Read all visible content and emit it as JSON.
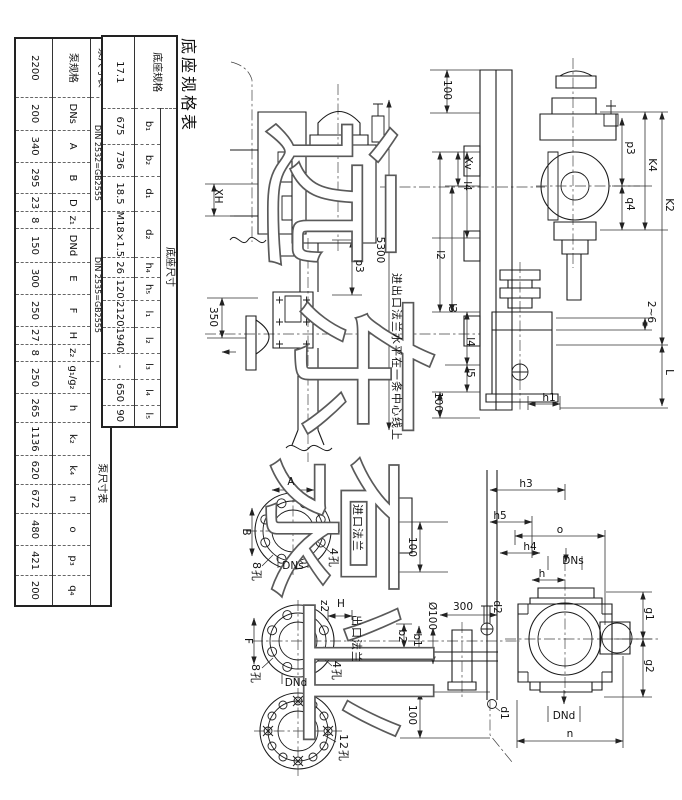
{
  "sheet_title": "底座规格表",
  "watermark_chars": [
    "远",
    "东",
    "泵",
    "业"
  ],
  "pump_table": {
    "title": "泵尺寸表",
    "groups": {
      "spec_title": "泵尺寸表",
      "inlet_l1": "入口法兰 PN10",
      "inlet_l2": "DIN 2532=GB2555",
      "outlet_l1": "出口法兰 PN40",
      "outlet_l2": "DIN 2535=GB2555",
      "tail_title": "泵尺寸表"
    },
    "columns": [
      "泵规格",
      "DNs",
      "A",
      "B",
      "D",
      "z₁",
      "DNd",
      "E",
      "F",
      "H",
      "z₂",
      "g₁/g₂",
      "h",
      "k₂",
      "k₄",
      "n",
      "o",
      "p₃",
      "q₄"
    ],
    "values": [
      "2200",
      "200",
      "340",
      "295",
      "23",
      "8",
      "150",
      "300",
      "250",
      "27",
      "8",
      "250",
      "265",
      "1136",
      "620",
      "672",
      "480",
      "421",
      "200"
    ]
  },
  "base_table": {
    "title": "底座规格表",
    "group_label": "底座尺寸",
    "spec_header": "底座规格",
    "columns": [
      "b₁",
      "b₂",
      "d₁",
      "d₂",
      "h₄",
      "h₅",
      "l₁",
      "l₂",
      "l₃",
      "l₄",
      "l₅"
    ],
    "values": [
      "17.1",
      "675",
      "736",
      "18.5",
      "M18×1.5",
      "26",
      "120",
      "2120",
      "1940",
      "-",
      "650",
      "90"
    ]
  },
  "labels": {
    "xh": "XH",
    "dim100_top": "100",
    "xv": "Xv",
    "l4_upper": "l4",
    "l2": "l2",
    "l3": "l3",
    "l4_lower": "l4",
    "l5": "l5",
    "dim100_mid": "100",
    "h1": "h1",
    "p3_side": "p3",
    "k4": "K4",
    "q4": "q4",
    "k2": "K2",
    "gap": "2~6",
    "L": "L",
    "dim350": "350",
    "p3_front": "p3",
    "note5300": "5300",
    "note": "进出口法兰水平在一条中心线上",
    "a": "A",
    "b": "B",
    "holes8_in": "8孔",
    "dns_inlet": "DNs",
    "holes4_in": "4孔",
    "inlet_flange": "进口法兰",
    "dim100_inlet": "100",
    "z2": "z2",
    "h_cap": "H",
    "f": "F",
    "outlet_flange": "出口法兰",
    "holes8_out": "8孔",
    "holes4_out": "4孔",
    "dnd_outlet": "DNd",
    "holes12": "12孔",
    "dia100": "Ø100",
    "dim300": "300",
    "b2": "b2",
    "b1": "b1",
    "dim100_bot": "100",
    "h3": "h3",
    "h5": "h5",
    "o": "o",
    "h4": "h4",
    "dns_end": "DNs",
    "h": "h",
    "d2": "d2",
    "g1": "g1",
    "g2": "g2",
    "d1": "d1",
    "dnd_end": "DNd",
    "n": "n"
  }
}
